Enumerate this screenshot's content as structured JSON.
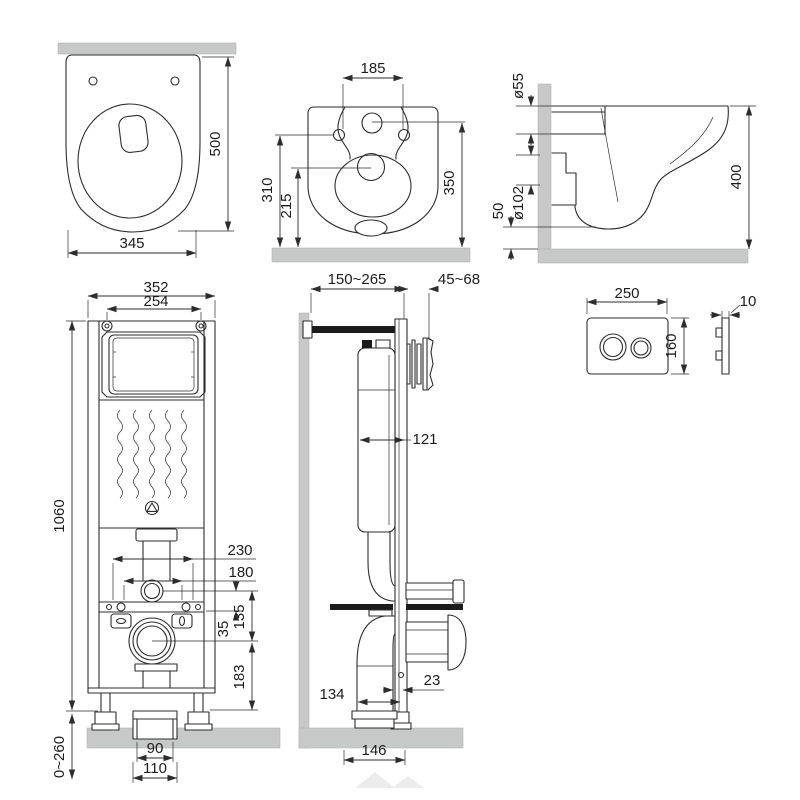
{
  "drawing_title": "Wall-hung toilet and installation frame dimensional drawing",
  "units": "mm",
  "colors": {
    "line": "#2d2d2d",
    "concrete_fill": "#c7c9c9",
    "hardware_black": "#1b1b1b"
  },
  "views": {
    "bowl_top": {
      "label": "toilet bowl top view",
      "depth": "500",
      "width": "345"
    },
    "bowl_rear": {
      "label": "toilet bowl rear view",
      "bolt_spacing": "185",
      "inlet_height": "310",
      "outlet_height": "215",
      "overall_height": "350"
    },
    "bowl_side": {
      "label": "toilet bowl side view",
      "inlet_diameter": "ø55",
      "outlet_diameter": "ø102",
      "bottom_offset": "50",
      "overall_height": "400"
    },
    "frame_front": {
      "label": "installation frame front view",
      "frame_width": "352",
      "bolt_spacing": "254",
      "frame_height": "1060",
      "outer_spacing": "230",
      "inner_spacing": "180",
      "inlet_drop": "135",
      "bar_offset": "35",
      "outlet_to_base": "183",
      "leg_range": "0~260",
      "drain_inner": "90",
      "drain_outer": "110"
    },
    "frame_side": {
      "label": "installation frame side view",
      "depth_range": "150~265",
      "stud_range": "45~68",
      "tank_depth": "121",
      "drain_offset": "134",
      "front_gap": "23",
      "drain_depth": "146"
    },
    "flush_plate": {
      "label": "flush plate",
      "width": "250",
      "height": "160",
      "thickness": "10"
    }
  }
}
